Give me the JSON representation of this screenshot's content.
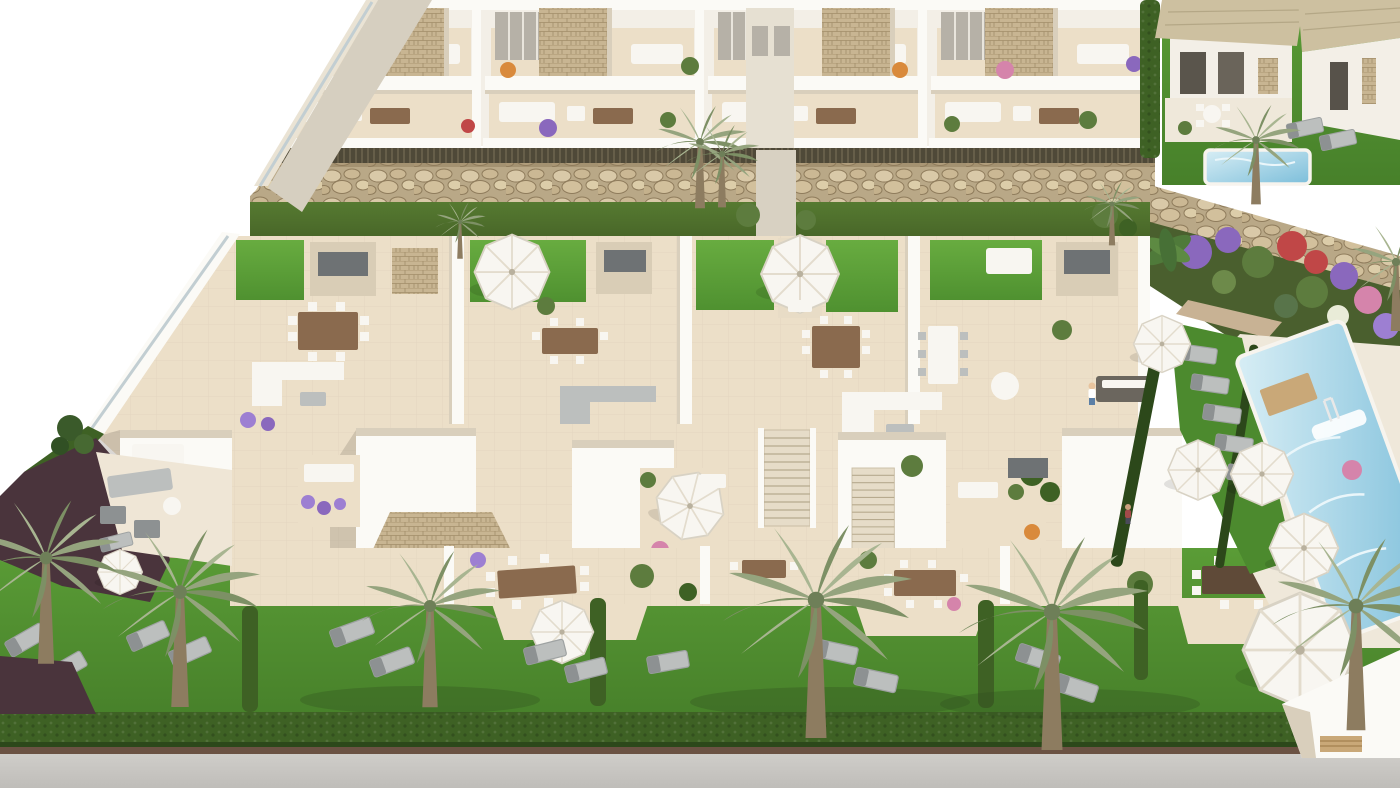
{
  "meta": {
    "title": "New-build residential complex — aerial 3D render",
    "description": "Photorealistic aerial 3D architectural rendering of a white Mediterranean residential development: a rear row of two-storey apartments with furnished terraces and stone-clad privacy panels, a gabion rock retaining wall over a lawn strip with palms, a large roof-terrace deck with artificial-grass patches, outdoor kitchens, dining sets, sofas and white parasols, stair towers with small balconies, ground-floor patios, hedged private gardens with grey sun loungers and tall palm trees, a long diagonal communal swimming pool with sunbathing lawn on the right, two detached villas with a private plunge pool and flowering garden at the top right, and a grey street along the bottom edge.",
    "alt": "Aerial view of a white residential complex with roof terraces, gardens, palm trees and swimming pools"
  },
  "palette": {
    "sky": "#ffffff",
    "wall": "#f3efe7",
    "wallBright": "#fbfaf6",
    "wallShade": "#d9cfbc",
    "deck": "#ecdfc8",
    "deckShade": "#dccdb2",
    "white": "#f8f6f1",
    "door": "#b6b1a7",
    "grayBox": "#6e7274",
    "furnGray": "#bcbfbe",
    "furnDark": "#8d9192",
    "wood": "#8a6a4e",
    "woodDark": "#5f4a38",
    "tan": "#c9a878",
    "roofTan": "#cdc0a0",
    "stone": "#c8b592",
    "stoneLine": "#a28d69",
    "rock": "#b9a887",
    "rockLight": "#d9c9a8",
    "rockDark": "#8f7c5c",
    "reed": "#4f4938",
    "reedLine": "#6f6750",
    "lawn": "#5a9c36",
    "lawnDark": "#47802a",
    "lawnPatch": "#68ac40",
    "lawnStrip": "#567a31",
    "hedge": "#3e6124",
    "hedgeDark": "#2c481a",
    "road": "#c7c5c1",
    "roadEdge": "#6b5243",
    "pathMaroon": "#4a343c",
    "poolLight": "#d8eef5",
    "poolDeep": "#7cbeda",
    "glass": "#c2ced2",
    "purple": "#8a68bd",
    "lavender": "#9d7fd2",
    "red": "#c04747",
    "pink": "#d584ab",
    "orange": "#d98a3c",
    "leaf": "#5d7c3e",
    "palm1": "#95a47e",
    "palm2": "#7d9065",
    "palm3": "#a8b591",
    "trunk": "#8d7c60",
    "shadow": "#2f4d1e"
  },
  "scene": {
    "view": "aerial oblique, sunlight from upper right",
    "objects": [
      {
        "label": "two-storey apartment terrace modules (back row)",
        "count": 4
      },
      {
        "label": "roof-terrace deck units with lawn patches",
        "count": 4
      },
      {
        "label": "stair towers / lower units",
        "count": 5
      },
      {
        "label": "detached villas (top right)",
        "count": 2
      },
      {
        "label": "communal swimming pool",
        "count": 1
      },
      {
        "label": "private plunge pool",
        "count": 1
      },
      {
        "label": "palm trees",
        "count": 12
      },
      {
        "label": "white parasols",
        "count": 11
      },
      {
        "label": "sun loungers",
        "count": 18
      },
      {
        "label": "outdoor dining sets",
        "count": 7
      },
      {
        "label": "gabion rock retaining walls",
        "count": 2
      },
      {
        "label": "hedged private gardens",
        "count": 5
      },
      {
        "label": "street / pavement",
        "count": 1
      }
    ]
  }
}
